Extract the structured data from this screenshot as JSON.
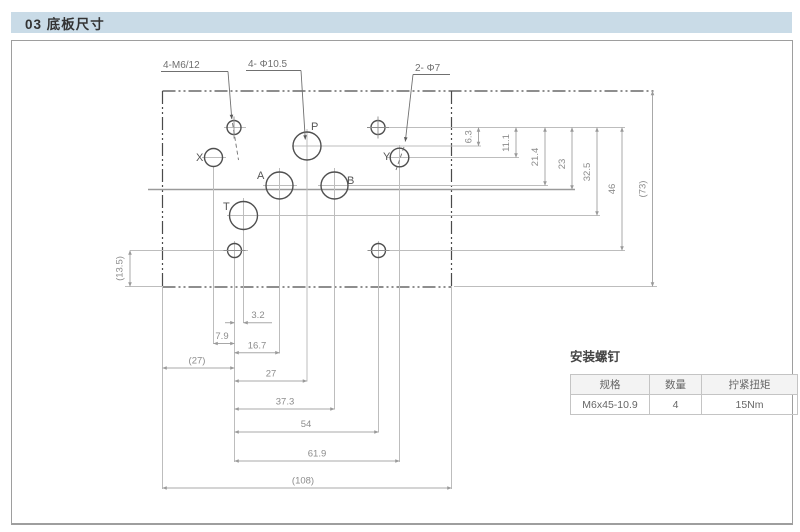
{
  "header": {
    "title": "03 底板尺寸"
  },
  "drawing": {
    "leaders": {
      "m6": "4-M6/12",
      "d105": "4- Φ10.5",
      "d7": "2- Φ7"
    },
    "ports": {
      "p": "P",
      "a": "A",
      "b": "B",
      "t": "T",
      "x": "X",
      "y": "Y"
    },
    "dims_right": [
      "6.3",
      "11.1",
      "21.4",
      "23",
      "32.5",
      "46",
      "(73)"
    ],
    "dims_bottom": [
      "3.2",
      "7.9",
      "16.7",
      "(27)",
      "27",
      "37.3",
      "54",
      "61.9",
      "(108)"
    ],
    "dims_left": [
      "(13.5)"
    ]
  },
  "screws_table": {
    "title": "安装螺钉",
    "headers": [
      "规格",
      "数量",
      "拧紧扭矩"
    ],
    "rows": [
      [
        "M6x45-10.9",
        "4",
        "15Nm"
      ]
    ]
  },
  "colors": {
    "titlebar_bg": "#c9dbe7",
    "frame_border": "#9e9e9e",
    "outline_dark": "#4a4a4a",
    "line_light": "#bdbdbd",
    "dim_text": "#8c8c8c",
    "table_border": "#c4c4c4"
  }
}
